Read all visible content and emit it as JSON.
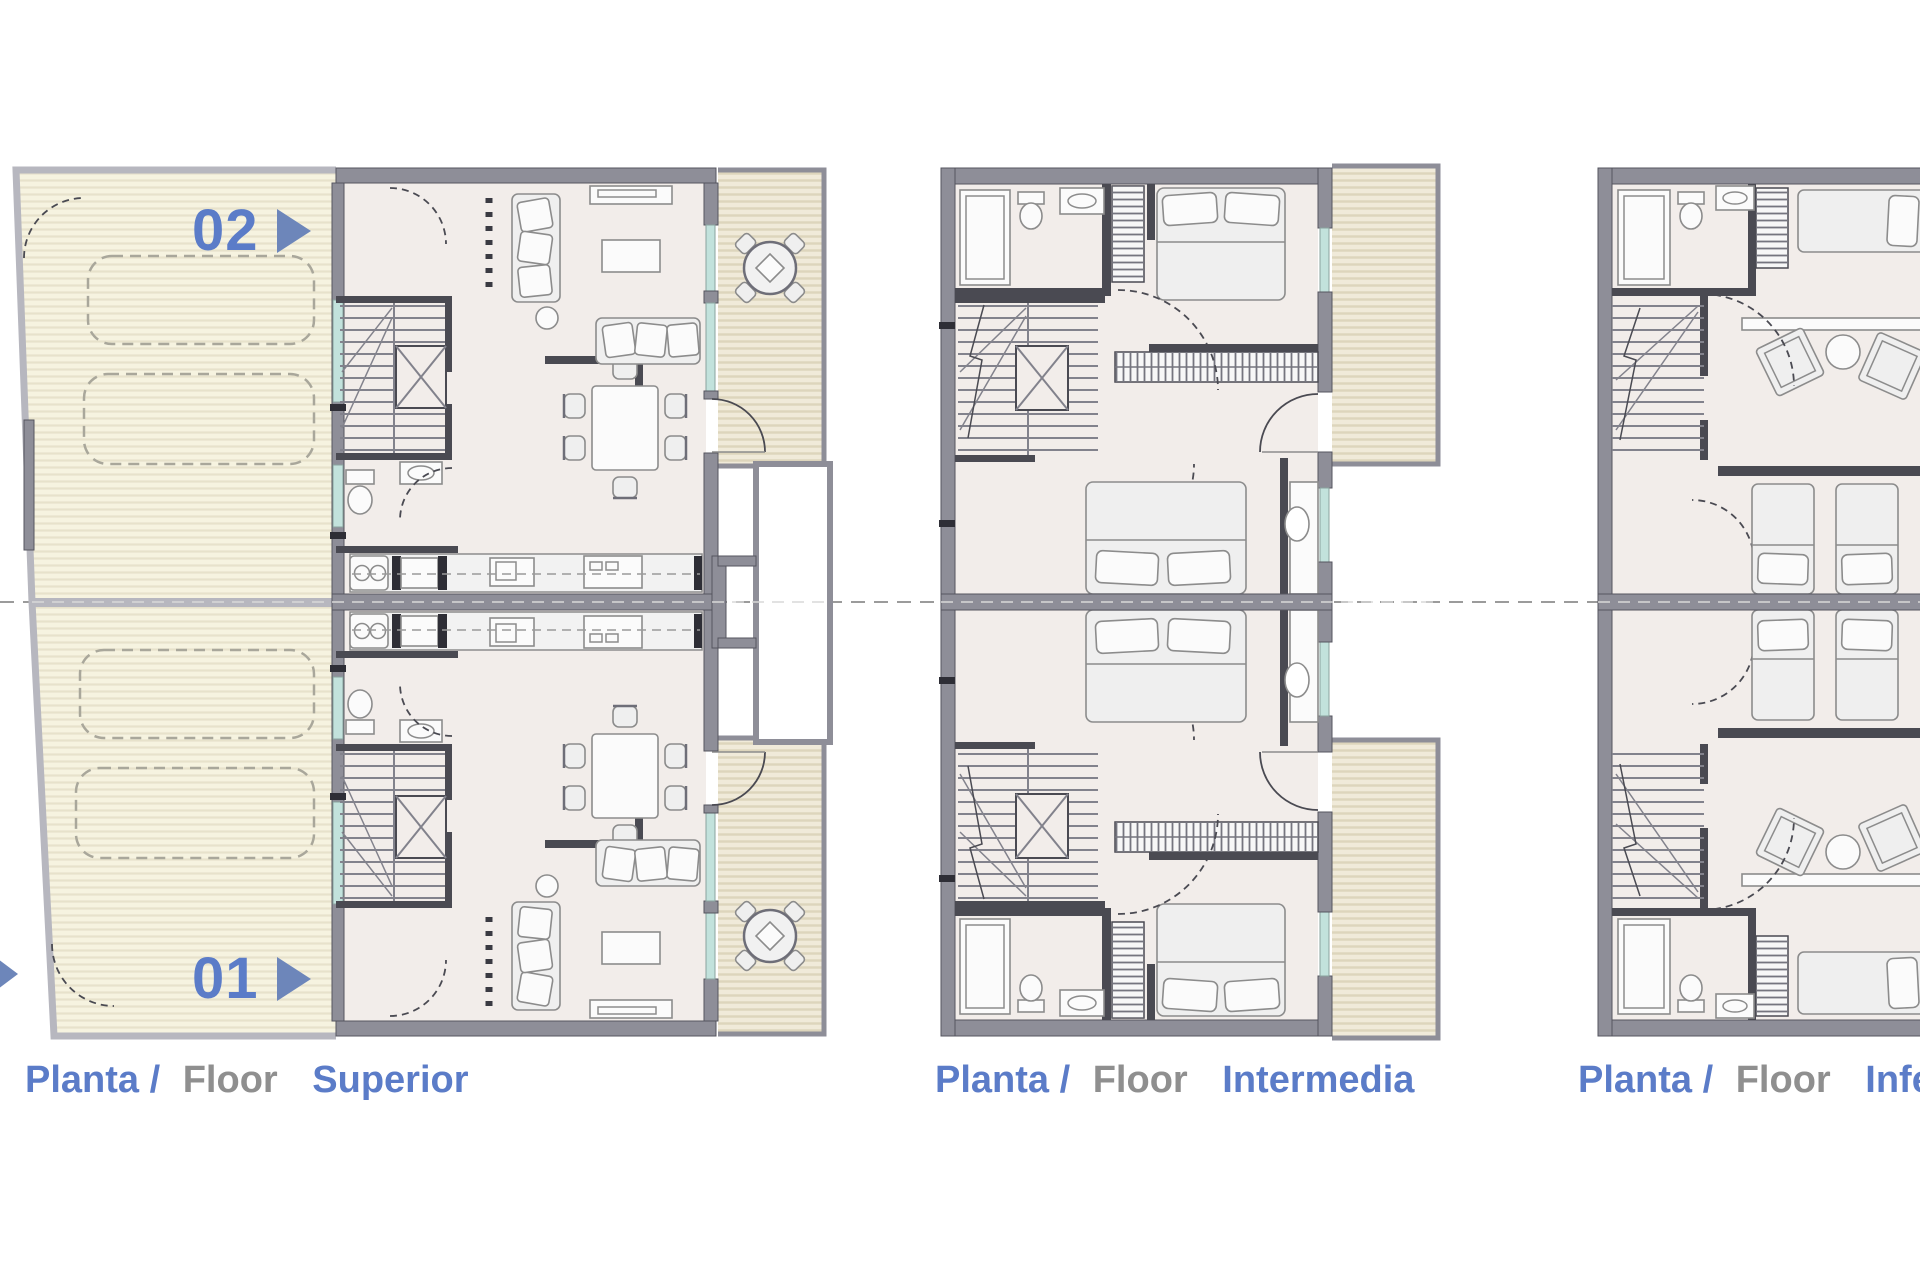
{
  "sheet": {
    "width": 1920,
    "height": 1280,
    "background": "#ffffff",
    "section_line": {
      "visible": true,
      "style": "dashed",
      "orientation": "horizontal"
    }
  },
  "colors": {
    "label_blue": "#5b7cc8",
    "label_gray": "#8f8f8f",
    "arrow_blue": "#6d86ba",
    "wall_gray": "#8e8e98",
    "wall_dark": "#55555f",
    "wall_light": "#b7b7bf",
    "partition": "#4a4a52",
    "floor": "#f2edea",
    "garage_floor": "#f6f3e0",
    "garage_stripe": "#e7e2cb",
    "deck": "#f0ead9",
    "deck_stripe": "#ddd5bc",
    "glazing": "#c2e2dc",
    "furniture_fill": "#efefef",
    "furniture_stroke": "#8c8c8c",
    "car_dash": "#a9a79b",
    "centerline": "#9b9b9b"
  },
  "plans": [
    {
      "id": "superior",
      "caption": {
        "planta": "Planta /",
        "floor": "Floor",
        "level": "Superior"
      },
      "unit_labels": [
        {
          "number": "02"
        },
        {
          "number": "01"
        }
      ]
    },
    {
      "id": "intermedia",
      "caption": {
        "planta": "Planta /",
        "floor": "Floor",
        "level": "Intermedia"
      },
      "unit_labels": []
    },
    {
      "id": "inferior",
      "caption": {
        "planta": "Planta /",
        "floor": "Floor",
        "level": "Inferior"
      },
      "unit_labels": []
    }
  ]
}
